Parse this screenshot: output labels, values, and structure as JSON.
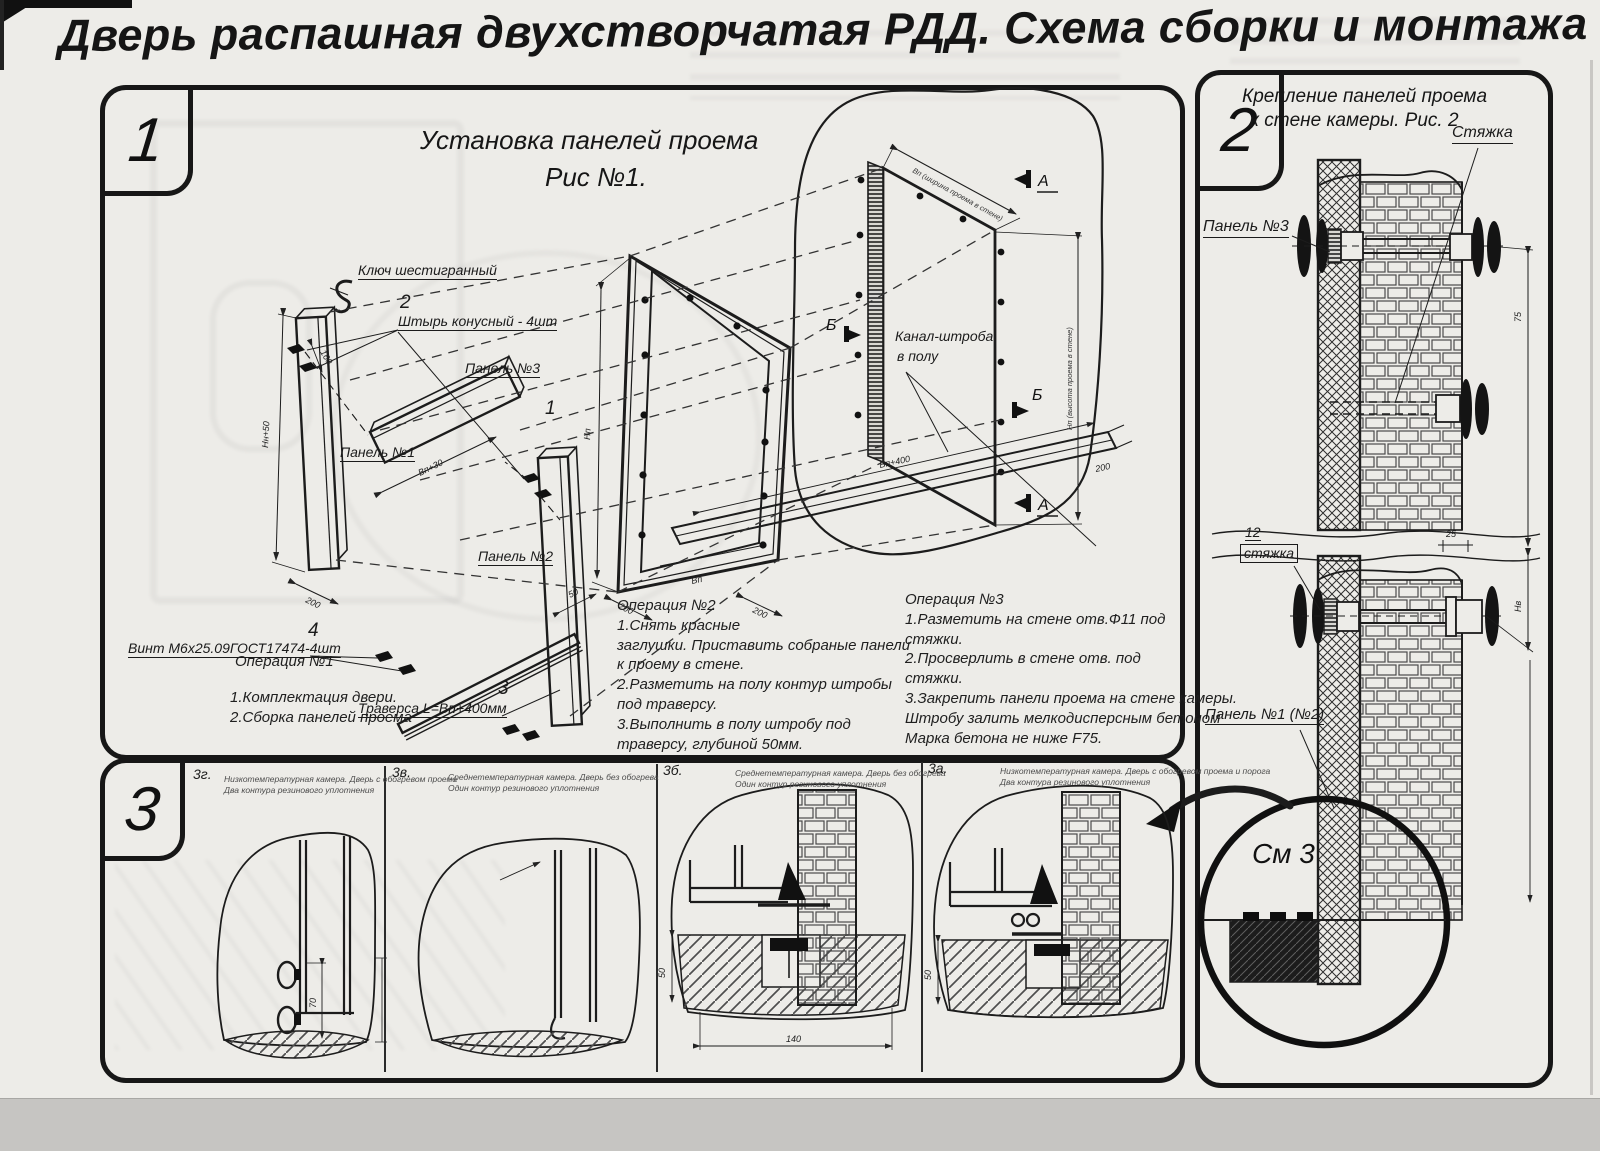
{
  "page": {
    "paper_color": "#edece8",
    "ink_color": "#171717",
    "band_color": "#c6c5c2"
  },
  "title": "Дверь распашная двухстворчатая РДД.  Схема сборки и монтажа №2",
  "section1": {
    "badge": "1",
    "heading1": "Установка панелей проема",
    "heading2": "Рис №1.",
    "labels": {
      "hex_key": "Ключ шестигранный",
      "pin_no": "2",
      "pin": "Штырь конусный - 4шт",
      "panel3": "Панель №3",
      "panel1": "Панель №1",
      "item1": "1",
      "panel2": "Панель №2",
      "screw_no": "4",
      "screw": "Винт М6х25.09ГОСТ17474-4шт",
      "trav_no": "3",
      "traverse": "Траверса  L=Вп+400мм",
      "channel1": "Канал-штроба",
      "channel2": "в полу",
      "marker_a": "А",
      "marker_b": "Б"
    },
    "dims": {
      "p1_height": "Нн+50",
      "p1_width": "200",
      "p3_len": "Вп+30",
      "pin_gap": "160",
      "frame_h": "Нп",
      "frame_200a": "200",
      "frame_vp": "Вп",
      "frame_200b": "200",
      "frame_50": "50",
      "chan_len": "Вп+400",
      "chan_200": "200",
      "open_w": "Вп (ширина проема в стене)",
      "open_h": "Нп (высота проема в стене)"
    },
    "op1": {
      "t": "Операция №1",
      "l1": "1.Комплектация двери.",
      "l2": "2.Сборка панелей проема"
    },
    "op2": {
      "t": "Операция №2",
      "l1": "1.Снять красные",
      "l2": "заглушки. Приставить собраные панели",
      "l3": "к проему в стене.",
      "l4": "2.Разметить на полу контур штробы",
      "l5": "под траверсу.",
      "l6": "3.Выполнить в полу штробу под",
      "l7": "траверсу, глубиной 50мм."
    },
    "op3": {
      "t": "Операция №3",
      "l1": "1.Разметить на стене отв.Ф11 под",
      "l2": "стяжки.",
      "l3": "2.Просверлить в стене отв.  под",
      "l4": "стяжки.",
      "l5": "3.Закрепить панели проема на стене камеры.",
      "l6": "Штробу залить мелкодисперсным бетоном",
      "l7": "Марка бетона не ниже   F75."
    }
  },
  "section2": {
    "badge": "2",
    "heading1": "Крепление панелей проема",
    "heading2": "к стене камеры. Рис. 2",
    "labels": {
      "tie": "Стяжка",
      "panel3": "Панель №3",
      "tie_no": "12",
      "tie_small": "стяжка",
      "panel12": "Панель №1 (№2)",
      "see": "См 3"
    },
    "dims": {
      "d75": "75",
      "d25": "25",
      "dnv": "Нв"
    }
  },
  "section3": {
    "badge": "3",
    "items": [
      {
        "label": "3г.",
        "cap1": "Низкотемпературная камера. Дверь с обогревом проема",
        "cap2": "Два контура резинового уплотнения"
      },
      {
        "label": "3в.",
        "cap1": "Среднетемпературная камера. Дверь без обогрева",
        "cap2": "Один контур резинового уплотнения"
      },
      {
        "label": "3б.",
        "cap1": "Среднетемпературная камера. Дверь без обогрева",
        "cap2": "Один контур резинового уплотнения"
      },
      {
        "label": "3а.",
        "cap1": "Низкотемпературная камера. Дверь с обогревом проема и порога",
        "cap2": "Два контура резинового уплотнения"
      }
    ],
    "dims": {
      "g_70": "70",
      "b_50": "50",
      "b_140": "140",
      "a_50": "50"
    }
  }
}
